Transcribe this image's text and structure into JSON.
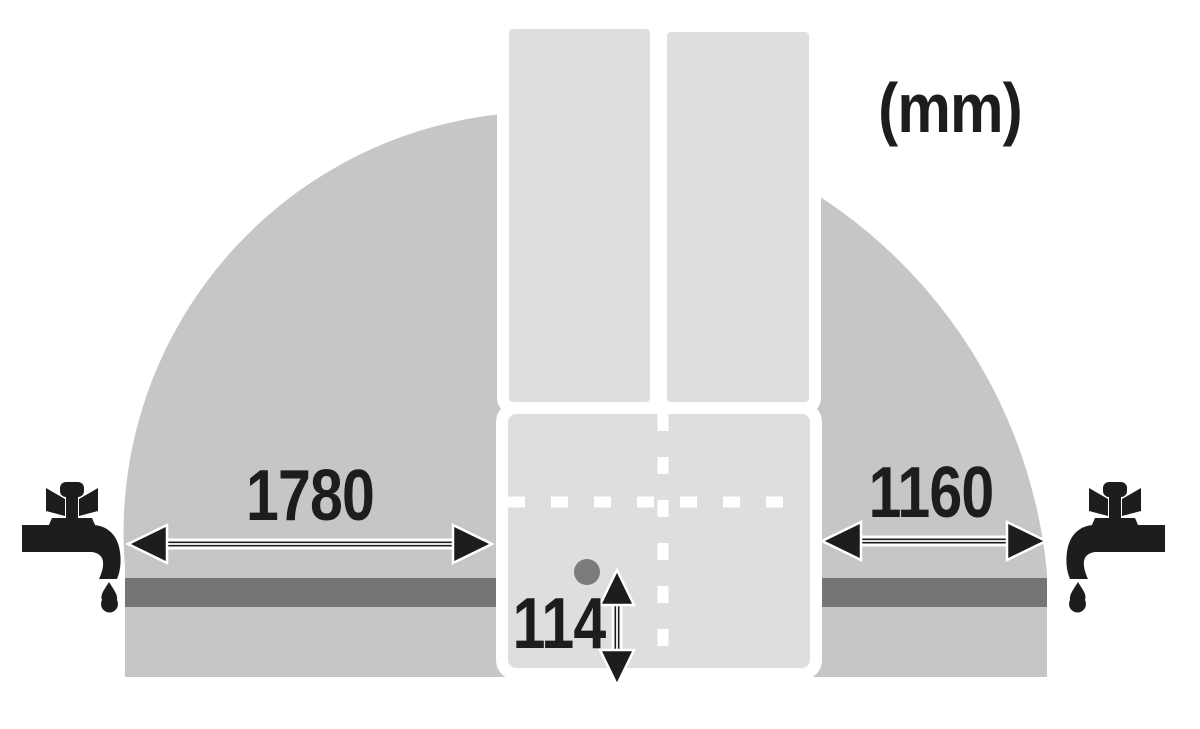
{
  "diagram": {
    "description": "Refrigerator top-view installation clearance diagram with door swing arcs and water tap connection distances",
    "unit_label": "(mm)",
    "dimensions": {
      "left_clearance": {
        "value": "1780"
      },
      "right_clearance": {
        "value": "1160"
      },
      "water_line_offset": {
        "value": "114"
      }
    },
    "icons": {
      "left": "faucet-icon",
      "right": "faucet-icon",
      "drip": "water-drop-icon",
      "connection": "water-connection-dot"
    },
    "colors": {
      "background": "#ffffff",
      "swing_area": "#c6c6c6",
      "panel": "#dedede",
      "water_bar": "#757575",
      "connection_dot": "#7b7b7b",
      "ink": "#1d1d1d",
      "dash_line": "#ffffff"
    }
  }
}
